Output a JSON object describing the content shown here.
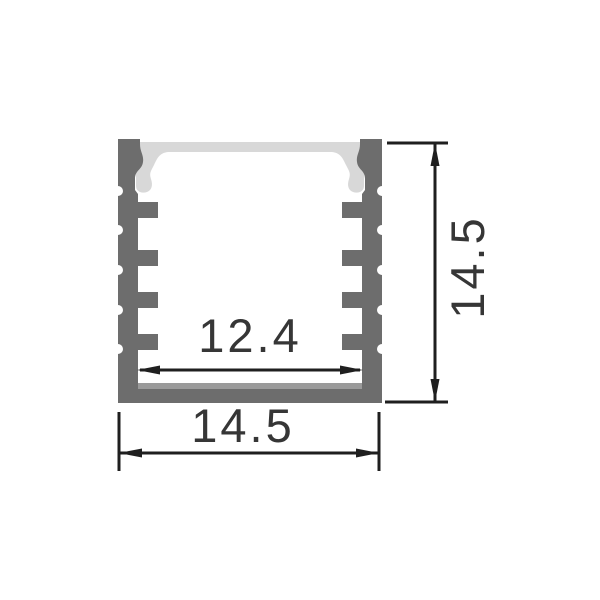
{
  "dimensions": {
    "inner_width": {
      "label": "12.4"
    },
    "outer_width": {
      "label": "14.5"
    },
    "height": {
      "label": "14.5"
    }
  },
  "colors": {
    "body": "#6d6d6d",
    "diffuser": "#d8d8d8",
    "floor_highlight": "#9a9a9a",
    "line": "#1f1f1f",
    "text": "#363636",
    "background": "#ffffff"
  }
}
